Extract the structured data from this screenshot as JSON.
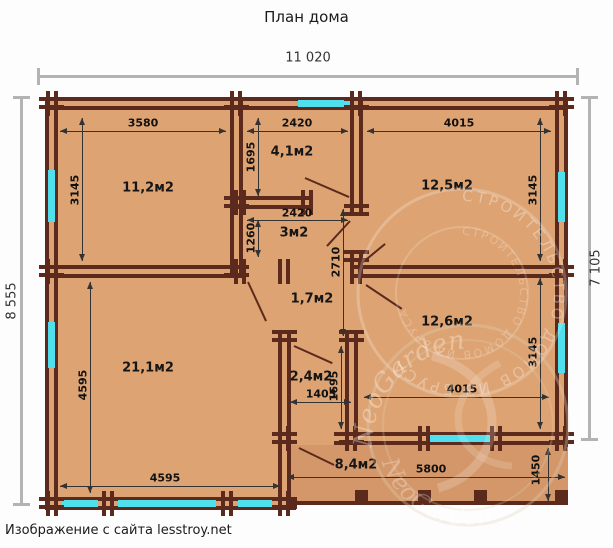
{
  "title": "План дома",
  "caption": "Изображение с сайта lesstroy.net",
  "overall": {
    "width": "11 020",
    "left_height": "8 555",
    "right_height": "7 105"
  },
  "rooms": {
    "r112": {
      "label": "11,2м2",
      "width": "3580",
      "height": "3145"
    },
    "r41": {
      "label": "4,1м2",
      "width": "2420",
      "height": "1695"
    },
    "r125": {
      "label": "12,5м2",
      "width": "4015",
      "height": "3145"
    },
    "r3": {
      "label": "3м2",
      "width": "2420",
      "height": "1260"
    },
    "r17": {
      "label": "1,7м2",
      "height": "2710"
    },
    "r126": {
      "label": "12,6м2",
      "width": "4015",
      "height": "3145"
    },
    "r211": {
      "label": "21,1м2",
      "width": "4595",
      "height": "4595"
    },
    "r24": {
      "label": "2,4м2",
      "width": "1405",
      "height": "1695"
    },
    "r84": {
      "label": "8,4м2",
      "width": "5800",
      "height": "1450"
    }
  },
  "watermark": {
    "ring": "СТРОИТЕЛЬСТВО ДОМОВ ИЗ БРУСА",
    "ring2": "СТРОИТЕЛЬСТВО ДОМОВ ИЗ БРУСА",
    "logo": "NeoGarden",
    "logo2": "NeoGarden"
  },
  "colors": {
    "floor": "#dda372",
    "porch": "#d39769",
    "wall": "#5b2a1d",
    "window": "#50dfec",
    "outer_dim": "#b3b3b3",
    "inner_dim": "#333333"
  }
}
